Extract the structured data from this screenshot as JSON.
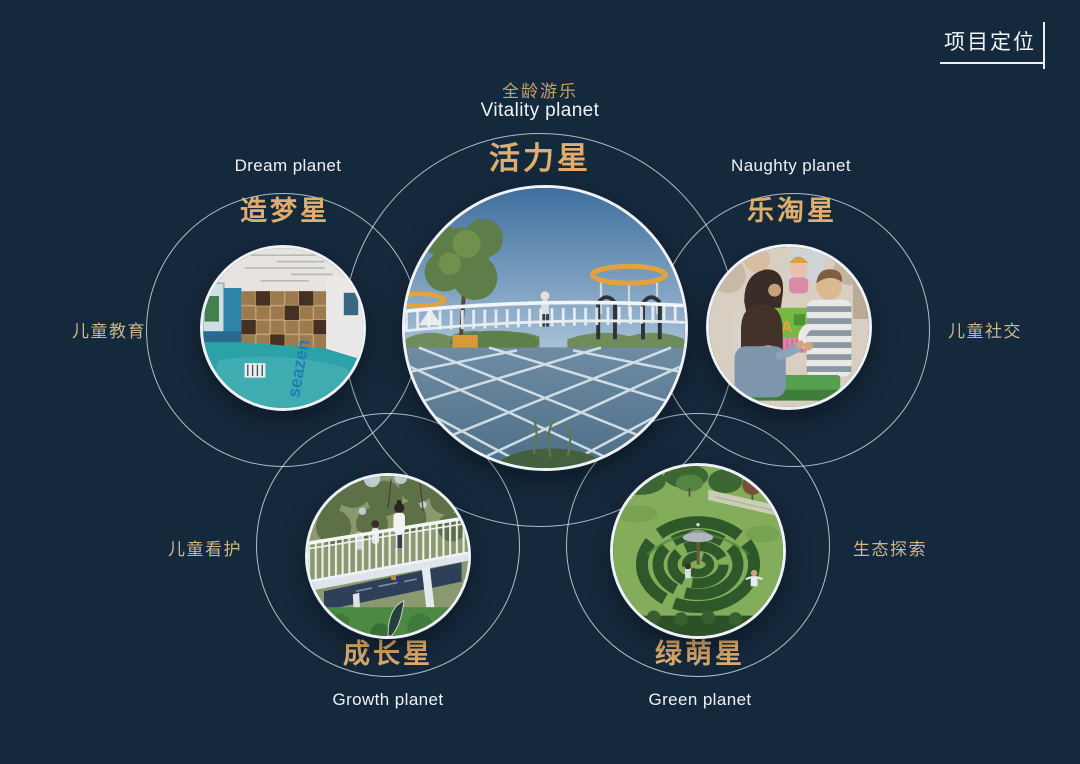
{
  "slide": {
    "title": "项目定位",
    "background_color": "#15293d",
    "accent_gold": "#e0ad6c",
    "label_tan": "#cdb68c",
    "outline_color": "#e4edf5"
  },
  "planets": {
    "vitality": {
      "category": "全龄游乐",
      "name_en": "Vitality planet",
      "name_zh": "活力星",
      "photo_desc": "Playground plaza with white curved bridge, yellow canopy rings, trees and blue paving with white grid lines"
    },
    "dream": {
      "name_en": "Dream planet",
      "name_zh": "造梦星",
      "side_label": "儿童教育",
      "photo_desc": "Children's education room with wooden bookshelf wall and teal floor",
      "photo_text": "seazen"
    },
    "naughty": {
      "name_en": "Naughty planet",
      "name_zh": "乐淘星",
      "side_label": "儿童社交",
      "photo_desc": "Children playing together with colorful letter blocks",
      "photo_text": "A"
    },
    "growth": {
      "name_en": "Growth planet",
      "name_zh": "成长星",
      "side_label": "儿童看护",
      "photo_desc": "People walking on a white railing footbridge over a lawn"
    },
    "green": {
      "name_en": "Green planet",
      "name_zh": "绿萌星",
      "side_label": "生态探索",
      "photo_desc": "Aerial view of a circular hedge maze with a central pavilion"
    }
  }
}
